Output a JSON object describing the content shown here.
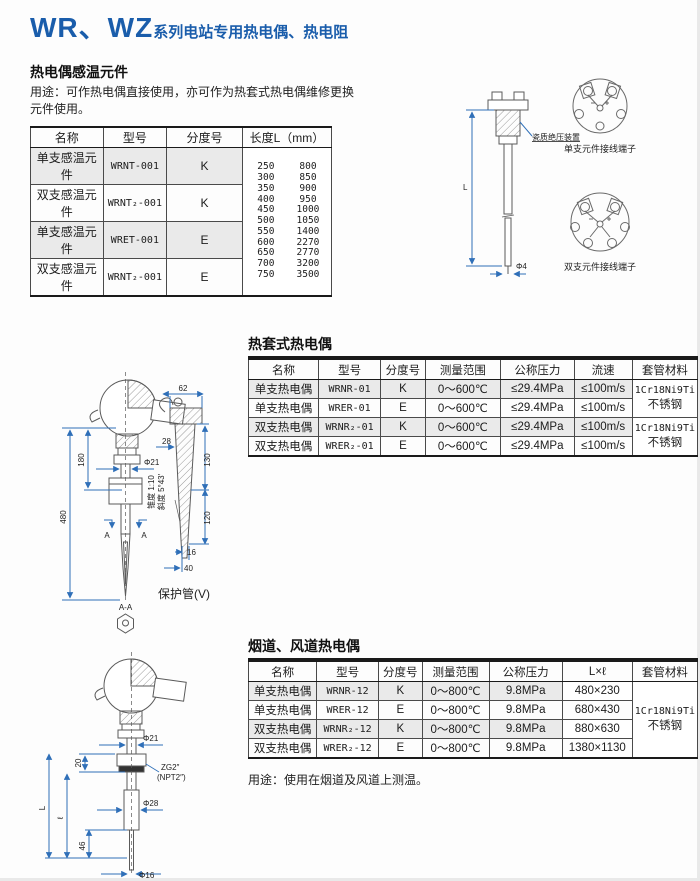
{
  "colors": {
    "accent": "#1a5dab",
    "dimension_blue": "#2f6fb8",
    "row_shade": "#eaeaea"
  },
  "page_title": {
    "prefix": "WR、WZ",
    "suffix": "系列电站专用热电偶、热电阻"
  },
  "s1": {
    "heading": "热电偶感温元件",
    "usage_line1": "用途：可作热电偶直接使用，亦可作为热套式热电偶维修更换",
    "usage_line2": "元件使用。",
    "table": {
      "headers": [
        "名称",
        "型号",
        "分度号",
        "长度L（mm）"
      ],
      "rows": [
        {
          "name": "单支感温元件",
          "model": "WRNT-001",
          "index": "K"
        },
        {
          "name": "双支感温元件",
          "model": "WRNT₂-001",
          "index": "K"
        },
        {
          "name": "单支感温元件",
          "model": "WRET-001",
          "index": "E"
        },
        {
          "name": "双支感温元件",
          "model": "WRNT₂-001",
          "index": "E"
        }
      ],
      "lengths": [
        [
          "250",
          "800"
        ],
        [
          "300",
          "850"
        ],
        [
          "350",
          "900"
        ],
        [
          "400",
          "950"
        ],
        [
          "450",
          "1000"
        ],
        [
          "500",
          "1050"
        ],
        [
          "550",
          "1400"
        ],
        [
          "600",
          "2270"
        ],
        [
          "650",
          "2770"
        ],
        [
          "700",
          "3200"
        ],
        [
          "750",
          "3500"
        ]
      ]
    },
    "diagram": {
      "dim_L": "L",
      "dim_tip": "Φ4",
      "callout": "瓷质绝压装置",
      "label_single": "单支元件接线端子",
      "label_double": "双支元件接线端子"
    }
  },
  "s2": {
    "heading": "热套式热电偶",
    "table": {
      "headers": [
        "名称",
        "型号",
        "分度号",
        "测量范围",
        "公称压力",
        "流速",
        "套管材料"
      ],
      "rows": [
        {
          "name": "单支热电偶",
          "model": "WRNR-01",
          "index": "K",
          "range": "0～600℃",
          "pressure": "≤29.4MPa",
          "velocity": "≤100m/s"
        },
        {
          "name": "单支热电偶",
          "model": "WRER-01",
          "index": "E",
          "range": "0～600℃",
          "pressure": "≤29.4MPa",
          "velocity": "≤100m/s"
        },
        {
          "name": "双支热电偶",
          "model": "WRNR₂-01",
          "index": "K",
          "range": "0～600℃",
          "pressure": "≤29.4MPa",
          "velocity": "≤100m/s"
        },
        {
          "name": "双支热电偶",
          "model": "WRER₂-01",
          "index": "E",
          "range": "0～600℃",
          "pressure": "≤29.4MPa",
          "velocity": "≤100m/s"
        }
      ],
      "material_lines": [
        "1Cr18Ni9Ti",
        "不锈钢"
      ]
    },
    "diagram": {
      "dim_180": "180",
      "dim_480": "480",
      "dim_phi21": "Φ21",
      "mark_A1": "A",
      "mark_A2": "A",
      "mark_AA": "A-A",
      "dim_62": "62",
      "dim_28": "28",
      "dim_130": "130",
      "dim_120": "120",
      "dim_16": "16",
      "dim_40": "40",
      "taper": "锥度 1:10",
      "slope": "斜度 5°43′",
      "label": "保护管(V)"
    }
  },
  "s3": {
    "heading": "烟道、风道热电偶",
    "table": {
      "headers": [
        "名称",
        "型号",
        "分度号",
        "测量范围",
        "公称压力",
        "L×ℓ",
        "套管材料"
      ],
      "rows": [
        {
          "name": "单支热电偶",
          "model": "WRNR-12",
          "index": "K",
          "range": "0～800℃",
          "pressure": "9.8MPa",
          "size": "480×230"
        },
        {
          "name": "单支热电偶",
          "model": "WRER-12",
          "index": "E",
          "range": "0～800℃",
          "pressure": "9.8MPa",
          "size": "680×430"
        },
        {
          "name": "双支热电偶",
          "model": "WRNR₂-12",
          "index": "K",
          "range": "0～800℃",
          "pressure": "9.8MPa",
          "size": "880×630"
        },
        {
          "name": "双支热电偶",
          "model": "WRER₂-12",
          "index": "E",
          "range": "0～800℃",
          "pressure": "9.8MPa",
          "size": "1380×1130"
        }
      ],
      "material_lines": [
        "1Cr18Ni9Ti",
        "不锈钢"
      ]
    },
    "note": "用途：使用在烟道及风道上测温。",
    "diagram": {
      "dim_phi21": "Φ21",
      "dim_20": "20",
      "thread1": "ZG2″",
      "thread2": "(NPT2″)",
      "dim_L": "L",
      "dim_l": "ℓ",
      "dim_phi28": "Φ28",
      "dim_46": "46",
      "dim_phi16": "Φ16"
    }
  }
}
